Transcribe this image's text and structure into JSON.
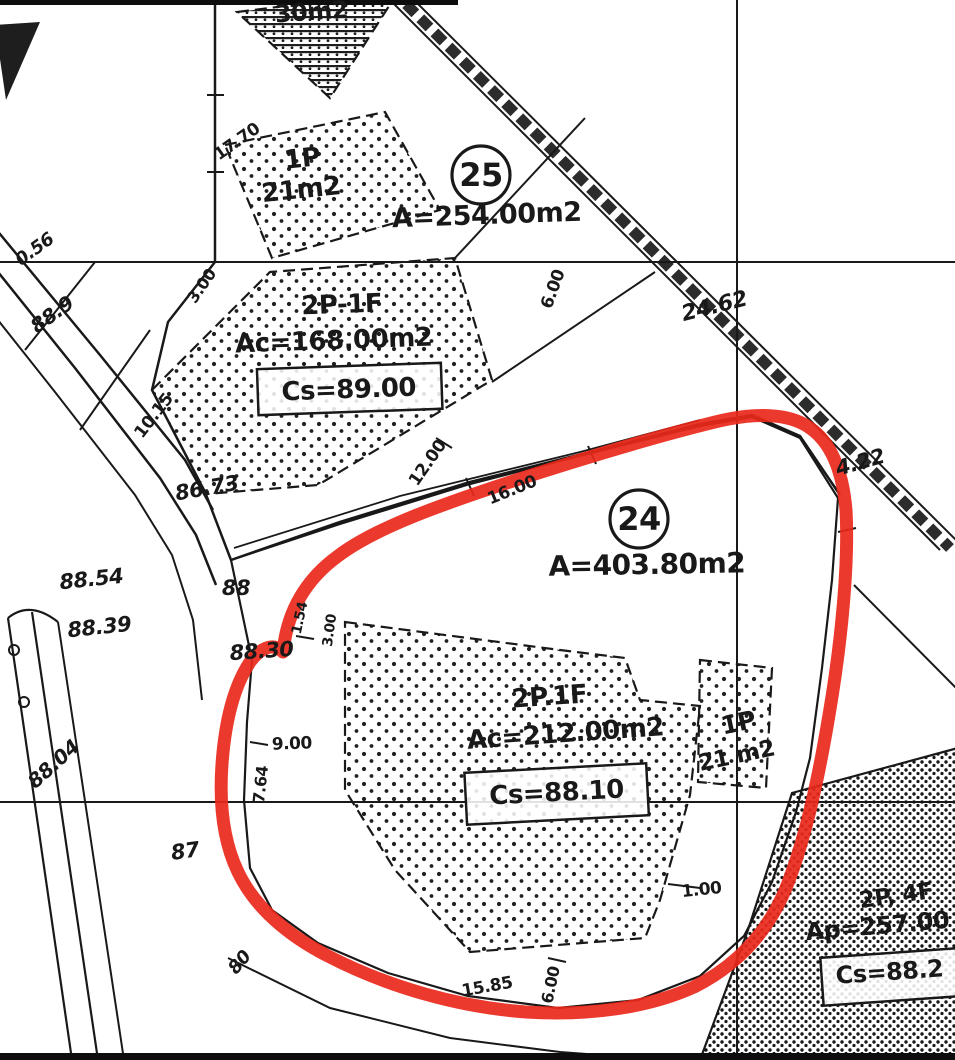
{
  "map": {
    "title": "cadastral-plan-scan",
    "colors": {
      "ink": "#1d1d1d",
      "red_outline": "#e62b1e",
      "paper": "#ffffff"
    },
    "parcels": [
      {
        "name": "parcel-25",
        "number": "25",
        "area": "A=254.00m2",
        "circle": {
          "x": 481,
          "y": 175,
          "r": 29
        },
        "area_pos": {
          "x": 487,
          "y": 224,
          "size": 27,
          "rot": -2
        }
      },
      {
        "name": "parcel-24",
        "number": "24",
        "area": "A=403.80m2",
        "circle": {
          "x": 639,
          "y": 519,
          "r": 29
        },
        "area_pos": {
          "x": 647,
          "y": 574,
          "size": 28,
          "rot": -1
        }
      }
    ],
    "labels": [
      {
        "name": "building-label-30m2",
        "text": "30m2",
        "x": 312,
        "y": 20,
        "size": 24,
        "rot": -4
      },
      {
        "name": "building-label-1p-25",
        "text": "1P",
        "x": 303,
        "y": 167,
        "size": 26,
        "rot": -6
      },
      {
        "name": "building-label-21m2-25",
        "text": "21m2",
        "x": 302,
        "y": 198,
        "size": 26,
        "rot": -6
      },
      {
        "name": "building-label-2p1f-25",
        "text": "2P-1F",
        "x": 342,
        "y": 313,
        "size": 26,
        "rot": -2
      },
      {
        "name": "building-label-ac168",
        "text": "Ac=168.00m2",
        "x": 334,
        "y": 349,
        "size": 26,
        "rot": -2
      },
      {
        "name": "building-label-cs89",
        "text": "Cs=89.00",
        "x": 349,
        "y": 398,
        "size": 26,
        "rot": -2,
        "box": {
          "x": 258,
          "y": 366,
          "w": 184,
          "h": 46
        }
      },
      {
        "name": "building-label-2p1f-24",
        "text": "2P.1F",
        "x": 550,
        "y": 705,
        "size": 26,
        "rot": -4
      },
      {
        "name": "building-label-ac212",
        "text": "Ac=212.00m2",
        "x": 566,
        "y": 742,
        "size": 26,
        "rot": -4
      },
      {
        "name": "building-label-cs8810",
        "text": "Cs=88.10",
        "x": 557,
        "y": 801,
        "size": 26,
        "rot": -3,
        "box": {
          "x": 466,
          "y": 768,
          "w": 182,
          "h": 52
        }
      },
      {
        "name": "building-label-1p-24",
        "text": "1P",
        "x": 740,
        "y": 731,
        "size": 25,
        "rot": -12
      },
      {
        "name": "building-label-21m2-24",
        "text": "21 m2",
        "x": 738,
        "y": 763,
        "size": 23,
        "rot": -12
      },
      {
        "name": "building-label-2p4f",
        "text": "2P, 4F",
        "x": 897,
        "y": 903,
        "size": 23,
        "rot": -8
      },
      {
        "name": "building-label-ap257",
        "text": "Ap=257.00",
        "x": 878,
        "y": 934,
        "size": 24,
        "rot": -5
      },
      {
        "name": "building-label-cs882",
        "text": "Cs=88.2",
        "x": 890,
        "y": 980,
        "size": 24,
        "rot": -4,
        "box": {
          "x": 822,
          "y": 953,
          "w": 136,
          "h": 48
        }
      },
      {
        "name": "dim-17-70",
        "text": "17.70",
        "x": 240,
        "y": 146,
        "size": 17,
        "rot": -35
      },
      {
        "name": "dim-0-56",
        "text": "0.56",
        "x": 38,
        "y": 254,
        "size": 18,
        "rot": -36,
        "italic": true
      },
      {
        "name": "spot-88-9",
        "text": "88.9",
        "x": 56,
        "y": 320,
        "size": 20,
        "rot": -36,
        "italic": true
      },
      {
        "name": "dim-3-00-a",
        "text": "3.00",
        "x": 206,
        "y": 289,
        "size": 16,
        "rot": -55
      },
      {
        "name": "dim-6-00-a",
        "text": "6.00",
        "x": 558,
        "y": 291,
        "size": 17,
        "rot": -70
      },
      {
        "name": "dim-10-15",
        "text": "10.15",
        "x": 158,
        "y": 419,
        "size": 17,
        "rot": -52
      },
      {
        "name": "dim-12-00",
        "text": "12.00",
        "x": 432,
        "y": 466,
        "size": 17,
        "rot": -55
      },
      {
        "name": "dim-16-00",
        "text": "16.00",
        "x": 514,
        "y": 495,
        "size": 17,
        "rot": -22
      },
      {
        "name": "spot-86-73",
        "text": "86.73",
        "x": 208,
        "y": 495,
        "size": 21,
        "rot": -10,
        "italic": true
      },
      {
        "name": "dim-24-62",
        "text": "24.62",
        "x": 716,
        "y": 313,
        "size": 22,
        "rot": -14,
        "italic": true
      },
      {
        "name": "dim-4-22",
        "text": "4.22",
        "x": 862,
        "y": 469,
        "size": 21,
        "rot": -16,
        "italic": true
      },
      {
        "name": "spot-88-54",
        "text": "88.54",
        "x": 92,
        "y": 586,
        "size": 21,
        "rot": -6,
        "italic": true
      },
      {
        "name": "spot-88-39",
        "text": "88.39",
        "x": 100,
        "y": 634,
        "size": 21,
        "rot": -6,
        "italic": true
      },
      {
        "name": "spot-88",
        "text": "88",
        "x": 236,
        "y": 595,
        "size": 21,
        "rot": 0,
        "italic": true
      },
      {
        "name": "spot-88-30",
        "text": "88.30",
        "x": 262,
        "y": 658,
        "size": 21,
        "rot": -4,
        "italic": true
      },
      {
        "name": "spot-88-04",
        "text": "88.04",
        "x": 58,
        "y": 769,
        "size": 20,
        "rot": -42,
        "italic": true
      },
      {
        "name": "spot-87",
        "text": "87",
        "x": 186,
        "y": 858,
        "size": 21,
        "rot": -8,
        "italic": true
      },
      {
        "name": "dim-1-54",
        "text": "1.54",
        "x": 304,
        "y": 619,
        "size": 14,
        "rot": -78
      },
      {
        "name": "dim-3-00-b",
        "text": "3.00",
        "x": 334,
        "y": 631,
        "size": 14,
        "rot": -82
      },
      {
        "name": "dim-9-00",
        "text": "9.00",
        "x": 292,
        "y": 749,
        "size": 17,
        "rot": -2
      },
      {
        "name": "dim-7-64",
        "text": "7.64",
        "x": 266,
        "y": 785,
        "size": 16,
        "rot": -84
      },
      {
        "name": "spot-80",
        "text": "80",
        "x": 244,
        "y": 966,
        "size": 18,
        "rot": -50,
        "italic": true
      },
      {
        "name": "dim-15-85",
        "text": "15.85",
        "x": 488,
        "y": 992,
        "size": 17,
        "rot": -10
      },
      {
        "name": "dim-6-00-b",
        "text": "6.00",
        "x": 556,
        "y": 986,
        "size": 16,
        "rot": -78
      },
      {
        "name": "dim-1-00",
        "text": "1.00",
        "x": 702,
        "y": 895,
        "size": 17,
        "rot": -6
      }
    ]
  }
}
